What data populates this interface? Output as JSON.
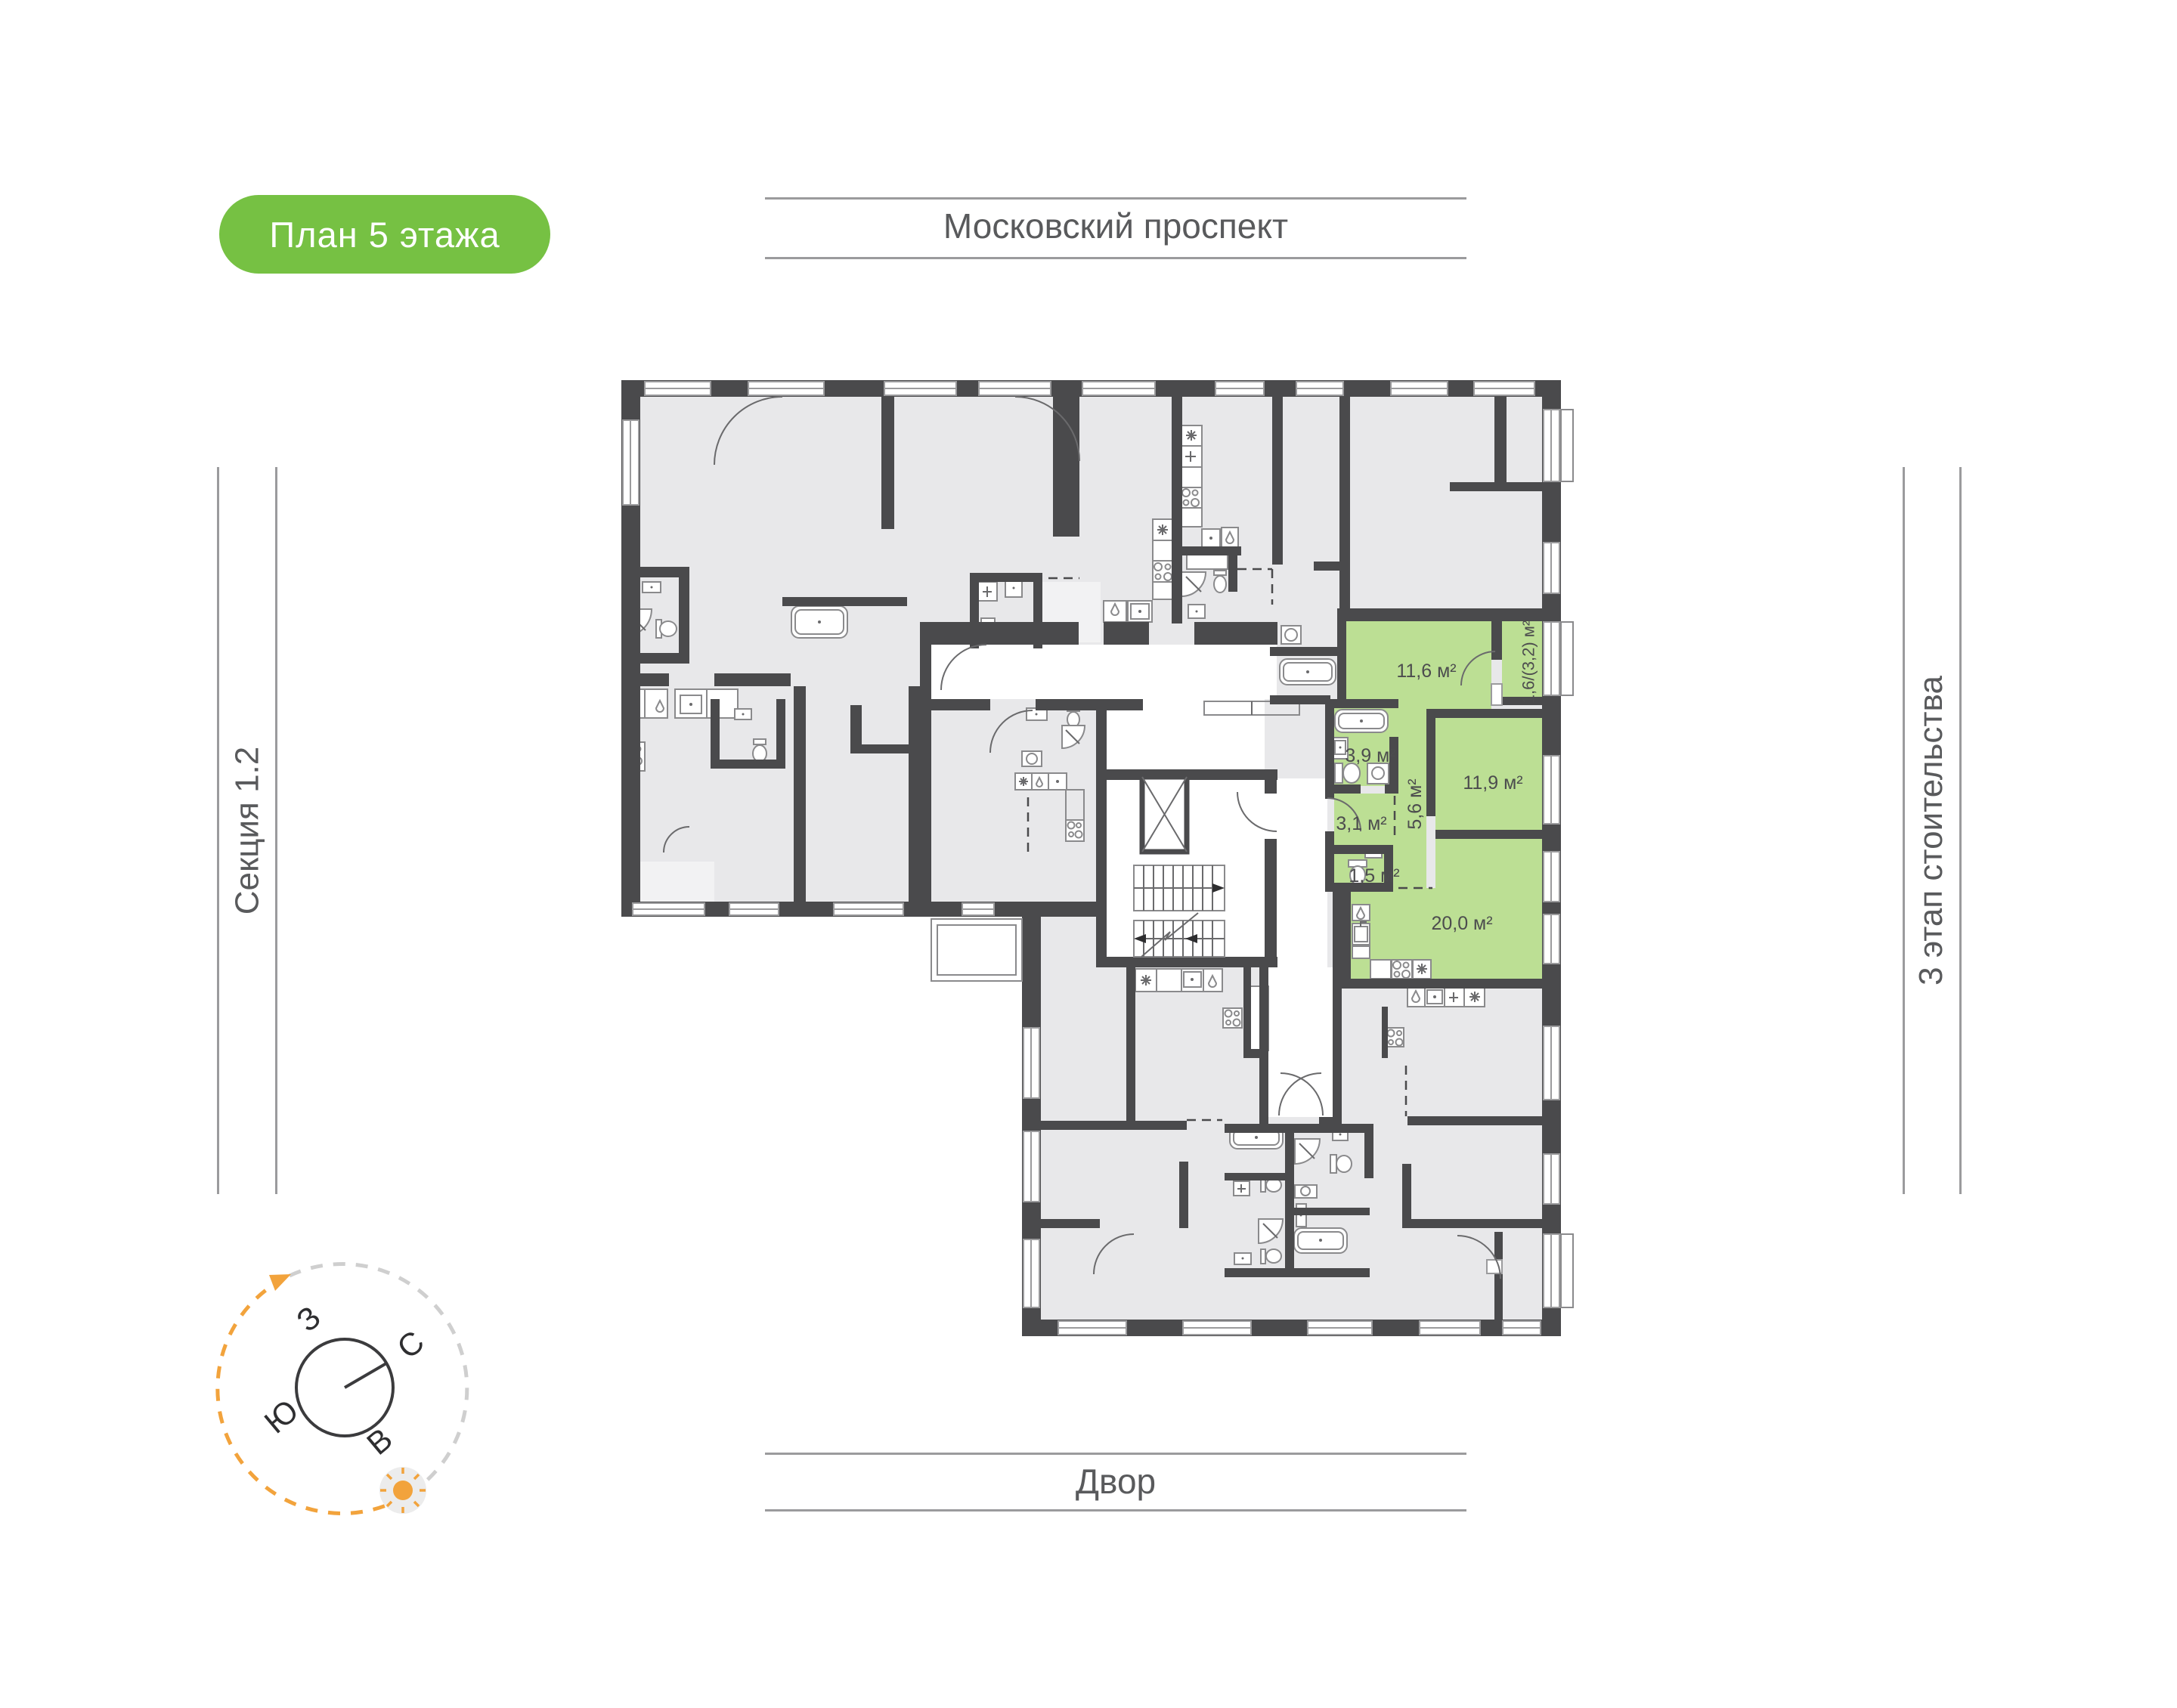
{
  "badge": {
    "label": "План 5 этажа",
    "bg_color": "#76c143",
    "text_color": "#ffffff"
  },
  "street": {
    "label": "Московский проспект"
  },
  "courtyard": {
    "label": "Двор"
  },
  "section": {
    "label": "Секция 1.2"
  },
  "stage": {
    "label": "3 этап стоительства"
  },
  "compass": {
    "north": "С",
    "south": "Ю",
    "west": "З",
    "east": "В",
    "sun_icon": "sun-icon",
    "arrow_icon": "rotation-arrow-icon"
  },
  "plan": {
    "highlight_color": "#bcdf94",
    "wall_color": "#4a4a4c",
    "room_fill": "#e8e8ea",
    "accent_orange": "#f2a33c",
    "apartment": {
      "rooms": [
        {
          "id": "hallway",
          "area": "11,6 м²"
        },
        {
          "id": "loggia",
          "area": "1,6/(3,2) м²"
        },
        {
          "id": "bathroom",
          "area": "3,9 м²"
        },
        {
          "id": "bedroom",
          "area": "11,9 м²"
        },
        {
          "id": "hall",
          "area": "3,1 м²"
        },
        {
          "id": "corridor",
          "area": "5,6 м²"
        },
        {
          "id": "wc",
          "area": "1,5 м²"
        },
        {
          "id": "kitchen_living",
          "area": "20,0 м²"
        }
      ]
    }
  }
}
